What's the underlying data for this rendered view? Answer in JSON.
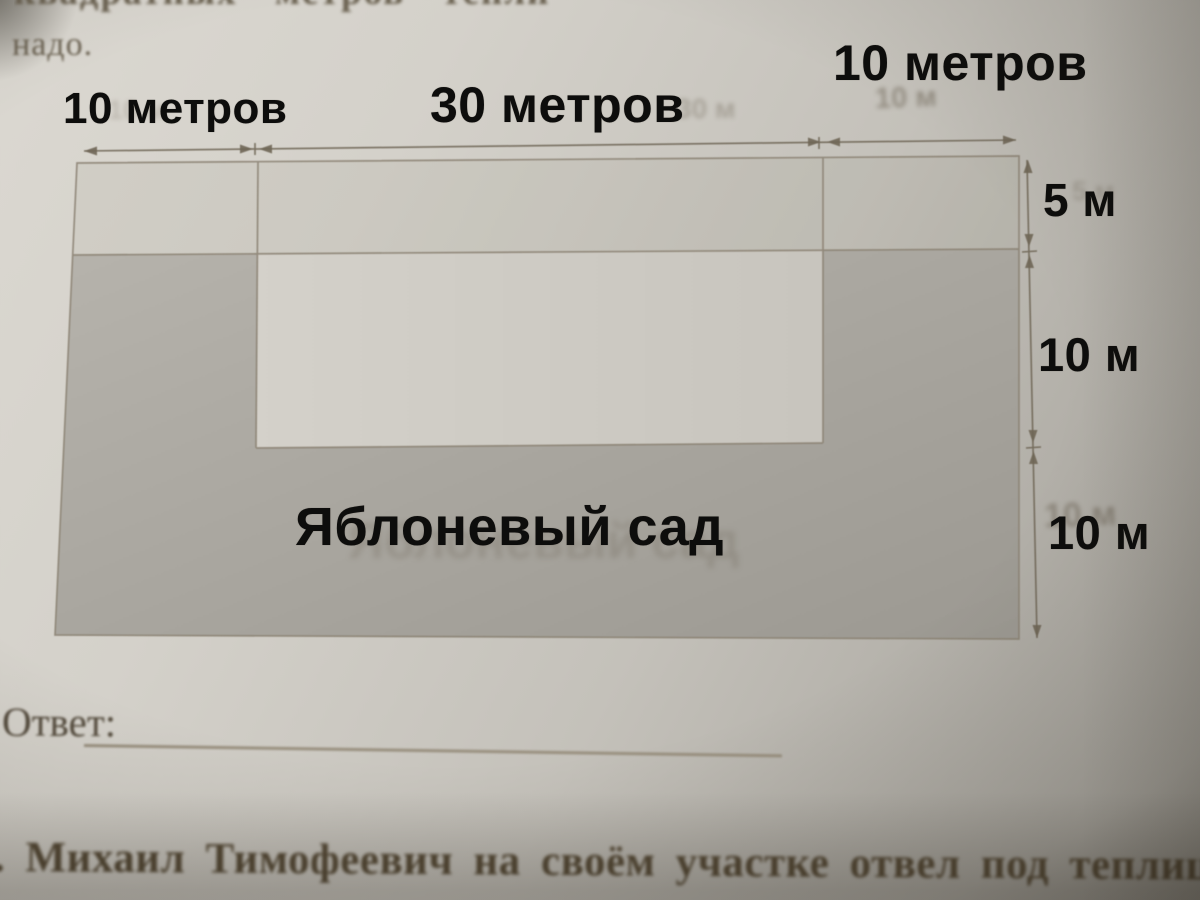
{
  "page": {
    "partial_top_line": "квадратных метров тепли",
    "top_line_2": "надо.",
    "answer_label": "Ответ:",
    "answer_value": "",
    "next_task_fragment": ". Михаил Тимофеевич на своём участке отвел под теплиц"
  },
  "diagram": {
    "orchard_label": "Яблоневый сад",
    "top_dims": [
      {
        "label": "10 метров",
        "meters": 10
      },
      {
        "label": "30 метров",
        "meters": 30
      },
      {
        "label": "10 метров",
        "meters": 10
      }
    ],
    "right_dims": [
      {
        "label": "5 м",
        "meters": 5
      },
      {
        "label": "10 м",
        "meters": 10
      },
      {
        "label": "10 м",
        "meters": 10
      }
    ],
    "ghosts": [
      "10 м",
      "30 м",
      "10 м",
      "5 м",
      "10 м",
      "Яблоневый сад"
    ],
    "colors": {
      "orchard_fill": "#a8a59e",
      "field_light": "#cfccc5",
      "figure_line": "#8a8172",
      "dimension_line": "#6f6656",
      "overlay_ink": "#0d0d0c",
      "print_ink": "#5a5040"
    }
  }
}
